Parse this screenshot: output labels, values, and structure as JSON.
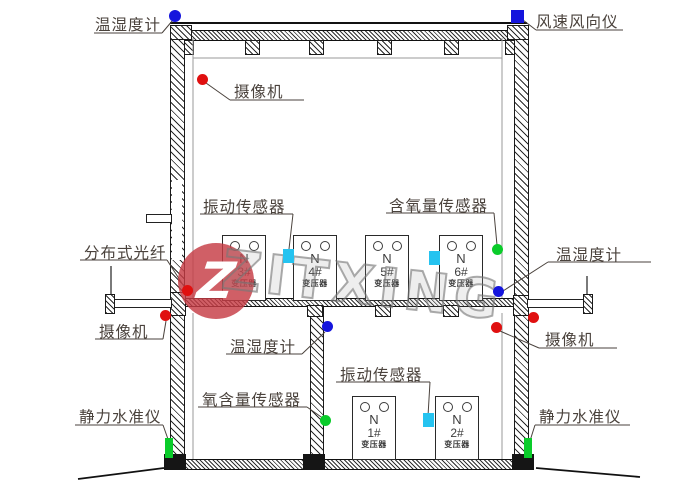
{
  "diagram": {
    "type": "building-section-sensor-layout",
    "annotations": [
      {
        "id": "temp-humidity-top-left",
        "label": "温湿度计"
      },
      {
        "id": "wind-speed-direction",
        "label": "风速风向仪"
      },
      {
        "id": "camera-upper",
        "label": "摄像机"
      },
      {
        "id": "vibration-upper",
        "label": "振动传感器"
      },
      {
        "id": "oxygen-upper",
        "label": "含氧量传感器"
      },
      {
        "id": "distributed-fiber",
        "label": "分布式光纤"
      },
      {
        "id": "temp-humidity-right",
        "label": "温湿度计"
      },
      {
        "id": "camera-lower-left",
        "label": "摄像机"
      },
      {
        "id": "temp-humidity-lower",
        "label": "温湿度计"
      },
      {
        "id": "vibration-lower",
        "label": "振动传感器"
      },
      {
        "id": "oxygen-lower",
        "label": "氧含量传感器"
      },
      {
        "id": "camera-lower-right",
        "label": "摄像机"
      },
      {
        "id": "static-level-left",
        "label": "静力水准仪"
      },
      {
        "id": "static-level-right",
        "label": "静力水准仪"
      }
    ],
    "transformers": [
      {
        "letter": "N",
        "number": "3#",
        "caption": "变压器"
      },
      {
        "letter": "N",
        "number": "4#",
        "caption": "变压器"
      },
      {
        "letter": "N",
        "number": "5#",
        "caption": "变压器"
      },
      {
        "letter": "N",
        "number": "6#",
        "caption": "变压器"
      },
      {
        "letter": "N",
        "number": "1#",
        "caption": "变压器"
      },
      {
        "letter": "N",
        "number": "2#",
        "caption": "变压器"
      }
    ],
    "watermark": {
      "text": "ZITXING",
      "logo_letter": "Z"
    },
    "colors": {
      "marker_blue": "#1515dd",
      "marker_red": "#e01010",
      "marker_green": "#0acc2a",
      "marker_cyan": "#25c3f0",
      "line": "#1a1a1a",
      "label_text": "#4a423c",
      "watermark_red": "#c63c44",
      "watermark_gray": "#787878"
    }
  }
}
